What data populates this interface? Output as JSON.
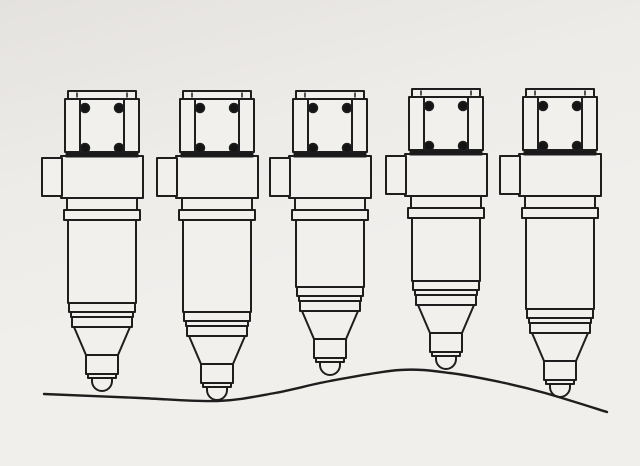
{
  "figure": {
    "kind": "technical-line-drawing",
    "subject": "row of five diesel unit fuel injectors standing on an uneven wavy surface",
    "injector_count": 5,
    "colors": {
      "paper": "#f2f0ed",
      "line": "#1e1e1e",
      "clamp_bar": "#1a1a1a",
      "bolt": "#141414"
    },
    "injectors": [
      {
        "cx": 102,
        "head_top": 91,
        "tip_y": 391
      },
      {
        "cx": 217,
        "head_top": 91,
        "tip_y": 400
      },
      {
        "cx": 330,
        "head_top": 91,
        "tip_y": 375
      },
      {
        "cx": 446,
        "head_top": 89,
        "tip_y": 369
      },
      {
        "cx": 560,
        "head_top": 89,
        "tip_y": 397
      }
    ],
    "ground_points": [
      [
        44,
        394
      ],
      [
        140,
        398
      ],
      [
        217,
        401
      ],
      [
        275,
        393
      ],
      [
        330,
        381
      ],
      [
        400,
        370
      ],
      [
        450,
        373
      ],
      [
        500,
        382
      ],
      [
        545,
        393
      ],
      [
        607,
        412
      ]
    ]
  }
}
